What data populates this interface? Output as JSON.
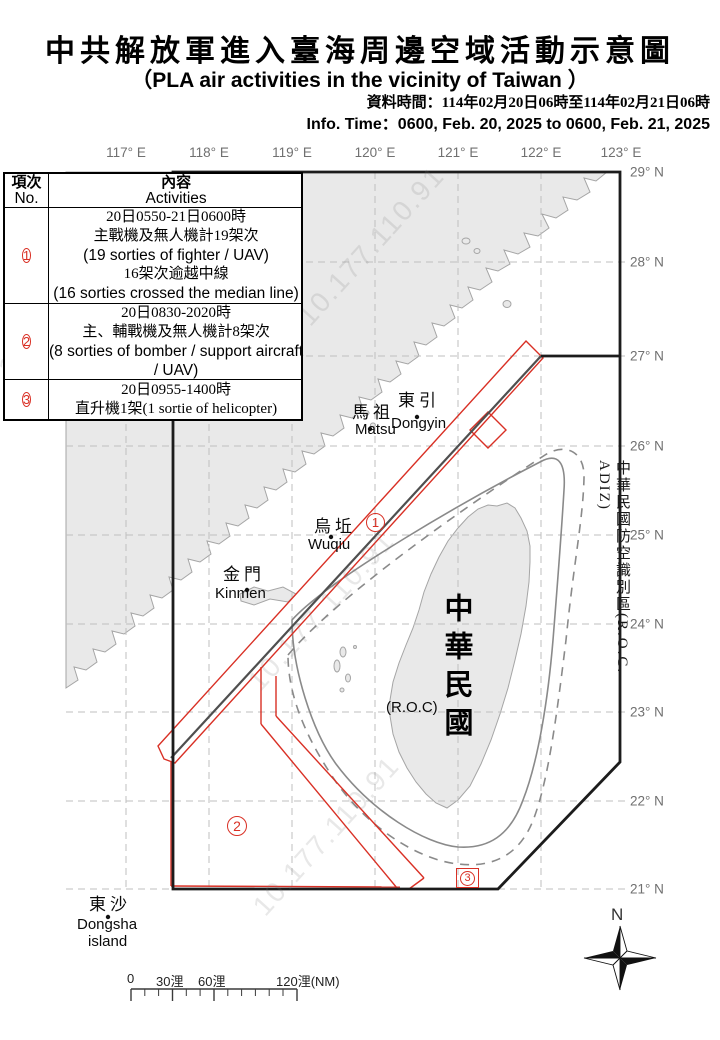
{
  "header": {
    "title_zh": "中共解放軍進入臺海周邊空域活動示意圖",
    "title_en": "（PLA air activities in the vicinity of Taiwan ）",
    "info_zh": "資料時間：114年02月20日06時至114年02月21日06時",
    "info_en": "Info. Time：0600, Feb. 20, 2025 to 0600, Feb. 21, 2025"
  },
  "table": {
    "header": {
      "col1_zh": "項次",
      "col1_en": "No.",
      "col2_zh": "內容",
      "col2_en": "Activities"
    },
    "rows": [
      {
        "num": "1",
        "lines": [
          "20日0550-21日0600時",
          "主戰機及無人機計19架次",
          "(19 sorties of fighter / UAV)",
          "16架次逾越中線",
          "(16 sorties crossed the median line)"
        ]
      },
      {
        "num": "2",
        "lines": [
          "20日0830-2020時",
          "主、輔戰機及無人機計8架次",
          "(8 sorties of bomber / support aircraft",
          "/ UAV)"
        ]
      },
      {
        "num": "3",
        "lines": [
          "20日0955-1400時",
          "直升機1架(1 sortie of helicopter)"
        ]
      }
    ]
  },
  "map": {
    "lon_labels": [
      "117° E",
      "118° E",
      "119° E",
      "120° E",
      "121° E",
      "122° E",
      "123° E"
    ],
    "lat_labels": [
      "29° N",
      "28° N",
      "27° N",
      "26° N",
      "25° N",
      "24° N",
      "23° N",
      "22° N",
      "21° N"
    ],
    "places": {
      "dongyin_zh": "東引",
      "dongyin_en": "Dongyin",
      "matsu_zh": "馬祖",
      "matsu_en": "Matsu",
      "wuqiu_zh": "烏坵",
      "wuqiu_en": "Wuqiu",
      "kinmen_zh": "金門",
      "kinmen_en": "Kinmen",
      "dongsha_zh": "東沙",
      "dongsha_en1": "Dongsha",
      "dongsha_en2": "island"
    },
    "roc_big": "中華民國",
    "roc_paren": "(R.O.C)",
    "adiz_label": "中華民國防空識別區(R.O.C. ADIZ)",
    "markers": {
      "m1": "1",
      "m2": "2",
      "m3": "3"
    },
    "compass_n": "N",
    "watermark": "10.177.110.91",
    "scale": {
      "t0": "0",
      "t30": "30浬",
      "t60": "60浬",
      "t120": "120浬(NM)"
    },
    "colors": {
      "activity_red": "#d93025",
      "adiz_line": "#1c1c1c",
      "median_line": "#4f4f4f",
      "land_fill": "#e9e9e9",
      "coast": "#a5a5a5",
      "contour": "#8a8a8a",
      "grid": "#bfbfbf",
      "label_gray": "#707070"
    }
  }
}
